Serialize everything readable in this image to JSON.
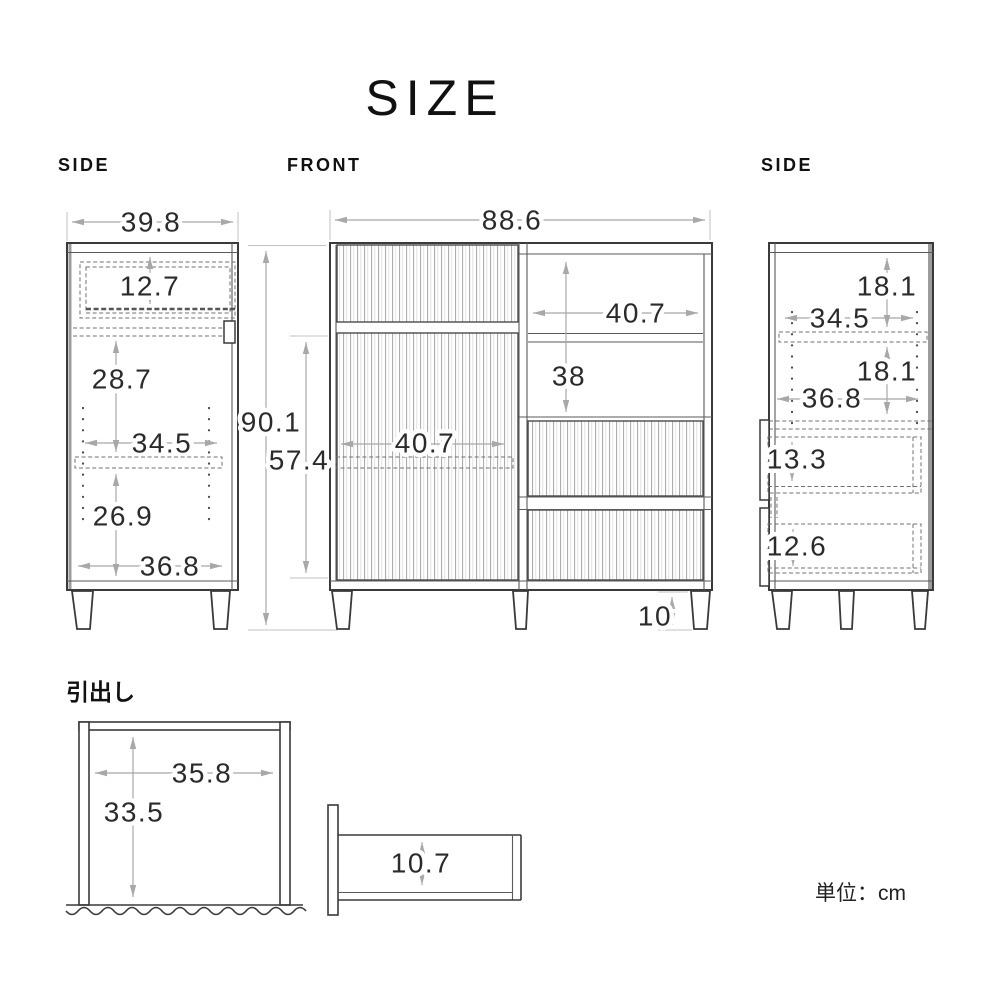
{
  "page": {
    "title": "SIZE",
    "unit_note": "単位：cm"
  },
  "views": {
    "side_left": {
      "label": "SIDE",
      "dims": {
        "width": "39.8",
        "top_drawer_height": "12.7",
        "upper_inner_height": "28.7",
        "shelf_width": "34.5",
        "lower_inner_height": "26.9",
        "inner_width": "36.8"
      }
    },
    "front": {
      "label": "FRONT",
      "dims": {
        "width": "88.6",
        "total_height": "90.1",
        "lower_height": "57.4",
        "open_width": "40.7",
        "open_height": "38",
        "door_inner_width": "40.7",
        "leg_height": "10"
      }
    },
    "side_right": {
      "label": "SIDE",
      "dims": {
        "upper_inner_height": "18.1",
        "shelf_width": "34.5",
        "middle_inner_height": "18.1",
        "inner_width": "36.8",
        "drawer1_height": "13.3",
        "drawer2_height": "12.6"
      }
    },
    "drawer_detail": {
      "label": "引出し",
      "dims": {
        "inner_width": "35.8",
        "inner_height": "33.5",
        "side_height": "10.7"
      }
    }
  },
  "colors": {
    "background": "#ffffff",
    "outline": "#3a3a3a",
    "dimension_line": "#a8a8a8",
    "dimension_text": "#2b2b2b",
    "flute_line": "#adadad",
    "back_panel": "#9c9c9c"
  }
}
